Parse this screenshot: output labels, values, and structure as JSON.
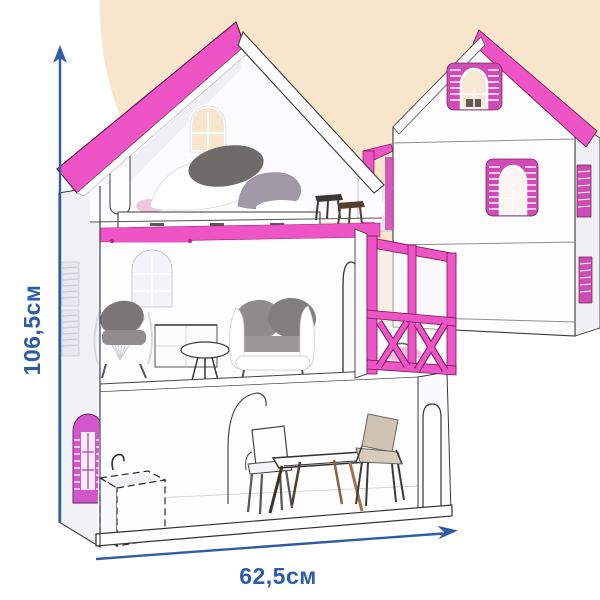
{
  "annotations": {
    "height_label": "106,5см",
    "width_label": "62,5см"
  },
  "icons": {
    "height_arrow": "arrow-up-icon",
    "width_arrow": "arrow-right-icon"
  },
  "colors": {
    "roof_pink": "#ee54c5",
    "shutter_pink": "#cf4cb5",
    "violet_pink": "#d357cc",
    "beige": "#f7e5cc",
    "dim_blue": "#2e5ca5",
    "wall_white": "#fdfdfe",
    "outline": "#3a3a3a"
  }
}
